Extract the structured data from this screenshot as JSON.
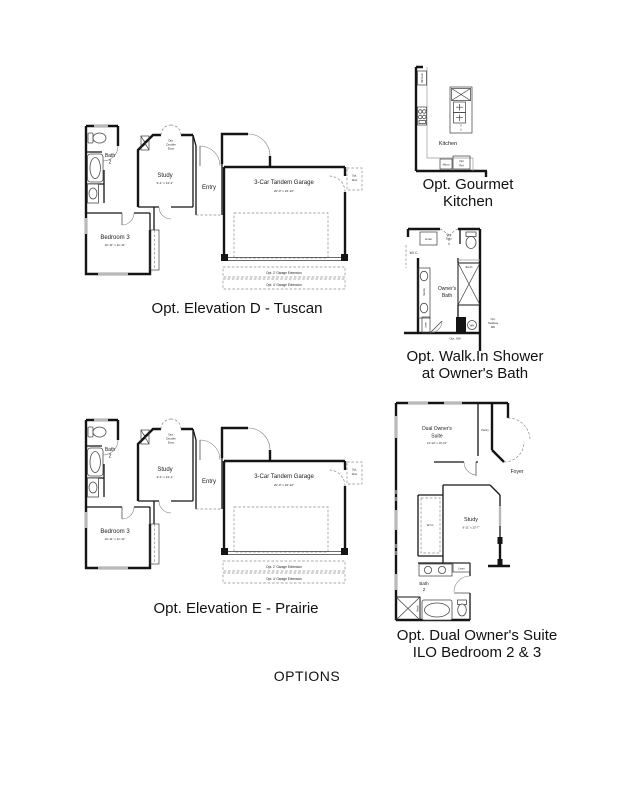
{
  "sheet": {
    "options_title": "OPTIONS"
  },
  "elevation_common": {
    "bath_line1": "Bath",
    "bath_line2": "2",
    "linen": "Linen",
    "opt_double_door_1": "Opt.",
    "opt_double_door_2": "Double",
    "opt_double_door_3": "Door",
    "study": "Study",
    "study_dim": "9'-1\" x 13'-1\"",
    "entry": "Entry",
    "bedroom": "Bedroom 3",
    "bedroom_dim": "10'-11\" x 11'-11\"",
    "garage": "3-Car Tandem Garage",
    "garage_dim": "20'-0\" x 19'-10\"",
    "opt_door_1": "Opt.",
    "opt_door_2": "Door",
    "ext2": "Opt. 2' Garage Extension",
    "ext4": "Opt. 4' Garage Extension"
  },
  "elevation_d": {
    "caption": "Opt. Elevation D - Tuscan"
  },
  "elevation_e": {
    "caption": "Opt. Elevation E - Prairie"
  },
  "gourmet_kitchen": {
    "caption_1": "Opt. Gourmet",
    "caption_2": "Kitchen",
    "room": "Kitchen",
    "dbl_oven": "Dbl Oven",
    "micro": "Micro",
    "opt_ref_1": "Opt",
    "opt_ref_2": "Ref"
  },
  "walkin_shower": {
    "caption_1": "Opt. Walk.In Shower",
    "caption_2": "at Owner's Bath",
    "linen_top": "Linen",
    "opt_door_1": "Opt.",
    "opt_door_2": "Door",
    "wic": "W.I.C.",
    "vanity": "Vanity",
    "owners_bath_1": "Owner's",
    "owners_bath_2": "Bath",
    "bench": "Bench",
    "linen_bottom": "Linen",
    "wh": "WH",
    "tankless_1": "Opt.",
    "tankless_2": "Tankless",
    "tankless_3": "WH",
    "opt_sw": "Opt. SW"
  },
  "dual_suite": {
    "caption_1": "Opt. Dual Owner's Suite",
    "caption_2": "ILO Bedroom 2 & 3",
    "suite_1": "Dual Owner's",
    "suite_2": "Suite",
    "suite_dim": "13'-10\" x 10'-11\"",
    "pantry": "Pantry",
    "foyer": "Foyer",
    "study": "Study",
    "study_dim": "9'-11\" x 13'-7\"",
    "wic": "W.I.C.",
    "linen": "Linen",
    "bath_1": "Bath",
    "bath_2": "2",
    "bench": "Bench"
  }
}
